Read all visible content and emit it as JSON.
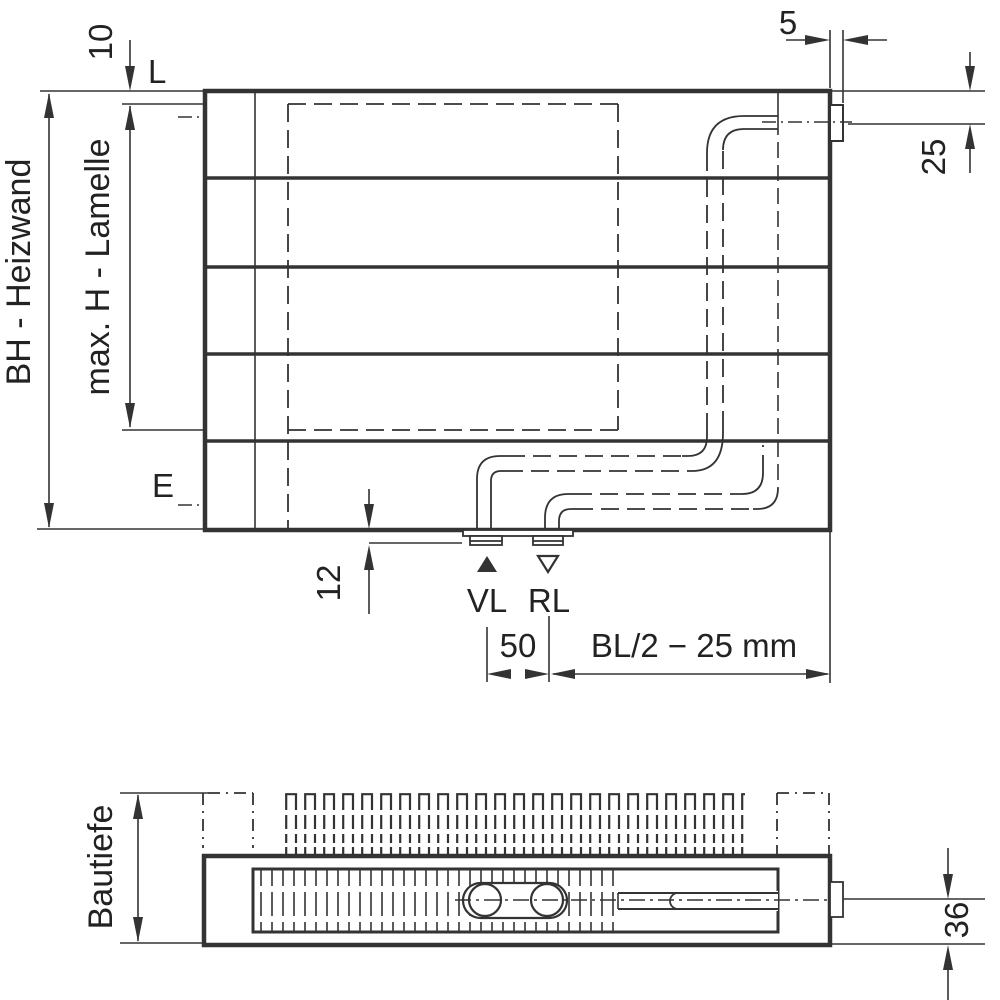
{
  "drawing": {
    "colors": {
      "line": "#333333",
      "thick_line": "#2d2d2d",
      "text": "#222222",
      "background": "#ffffff"
    },
    "front_view": {
      "height_dim_label": "BH - Heizwand",
      "lamella_height_dim_label": "max. H - Lamelle",
      "top_gap_dim": "10",
      "top_connection_centerline_label": "L",
      "bottom_connection_centerline_label": "E",
      "stub_width_dim": "5",
      "top_connection_offset_dim": "25",
      "bottom_gap_dim": "12",
      "supply_label": "VL",
      "return_label": "RL",
      "connection_spacing_dim": "50",
      "connection_position_dim": "BL/2 − 25 mm",
      "markers": {
        "supply": "filled-up-triangle",
        "return": "open-down-triangle"
      }
    },
    "plan_view": {
      "depth_dim_label": "Bautiefe",
      "bottom_offset_dim": "36"
    }
  }
}
